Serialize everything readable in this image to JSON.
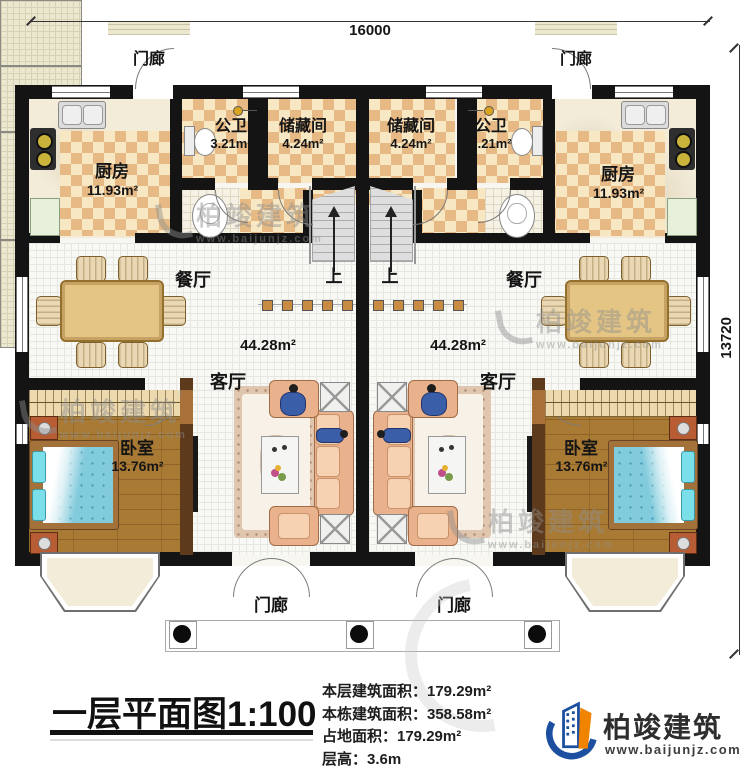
{
  "dimensions": {
    "top": "16000",
    "right": "13720"
  },
  "labels": {
    "porch": "门廊",
    "kitchen": "厨房",
    "kitchen_area": "11.93m²",
    "bathroom": "公卫",
    "bathroom_area": "3.21m²",
    "storage": "储藏间",
    "storage_area": "4.24m²",
    "dining": "餐厅",
    "hall_area": "44.28m²",
    "living": "客厅",
    "bedroom": "卧室",
    "bedroom_area": "13.76m²",
    "stairs_up": "上"
  },
  "footer": {
    "title": "一层平面图1:100",
    "stats": [
      "本层建筑面积：179.29m²",
      "本栋建筑面积：358.58m²",
      "占地面积：179.29m²",
      "层高：3.6m"
    ],
    "brand": {
      "name": "柏竣建筑",
      "url": "www.baijunjz.com"
    }
  },
  "watermark": {
    "name": "柏竣建筑",
    "url": "www.baijunjz.com"
  },
  "colors": {
    "wall": "#141414",
    "accent_blue": "#1c4fa0",
    "accent_orange": "#f08300"
  }
}
